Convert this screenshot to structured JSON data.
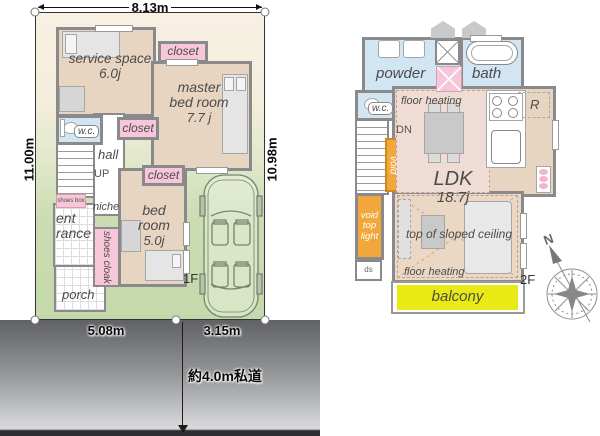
{
  "site": {
    "width_top": "8.13m",
    "height_left": "11.00m",
    "height_right": "10.98m",
    "frontage_left": "5.08m",
    "frontage_right": "3.15m",
    "road_label": "約4.0m私道"
  },
  "floor1": {
    "floor_tag": "1F",
    "service_space": {
      "name": "service space",
      "size": "6.0j"
    },
    "master_bedroom": {
      "line1": "master",
      "line2": "bed room",
      "size": "7.7 j"
    },
    "bedroom": {
      "line1": "bed",
      "line2": "room",
      "size": "5.0j"
    },
    "closet_label": "closet",
    "wc_label": "w.c.",
    "hall_label": "hall",
    "up_label": "UP",
    "niche_label": "niche",
    "shoes_box_label": "shoes box",
    "shoes_cloak_label": "shoes cloak",
    "entrance_line1": "ent",
    "entrance_line2": "rance",
    "porch_label": "porch"
  },
  "floor2": {
    "floor_tag": "2F",
    "powder_label": "powder",
    "bath_label": "bath",
    "wc_label": "w.c.",
    "floor_heating_label": "floor heating",
    "dn_label": "DN",
    "void_label": "void",
    "void_top_light_label": "void top light",
    "ds_label": "ds",
    "ldk": {
      "name": "LDK",
      "size": "18.7j"
    },
    "fridge_label": "R",
    "sloped_label": "top of sloped ceiling",
    "balcony_label": "balcony"
  },
  "compass": {
    "north": "N"
  },
  "colors": {
    "closet_pink": "#f7c6d8",
    "water_blue": "#d2e5f3",
    "void_orange": "#f2a73d",
    "balcony_yellow": "#e9e913",
    "floor_tan": "#e7d4c1",
    "floor_heating_pink": "#efdcd5",
    "plot_cream": "#f8f1e3",
    "plot_green": "#c4d9ab",
    "wall_gray": "#8a8a8c",
    "road_dark": "#606164",
    "road_light": "#d7d8d9"
  }
}
